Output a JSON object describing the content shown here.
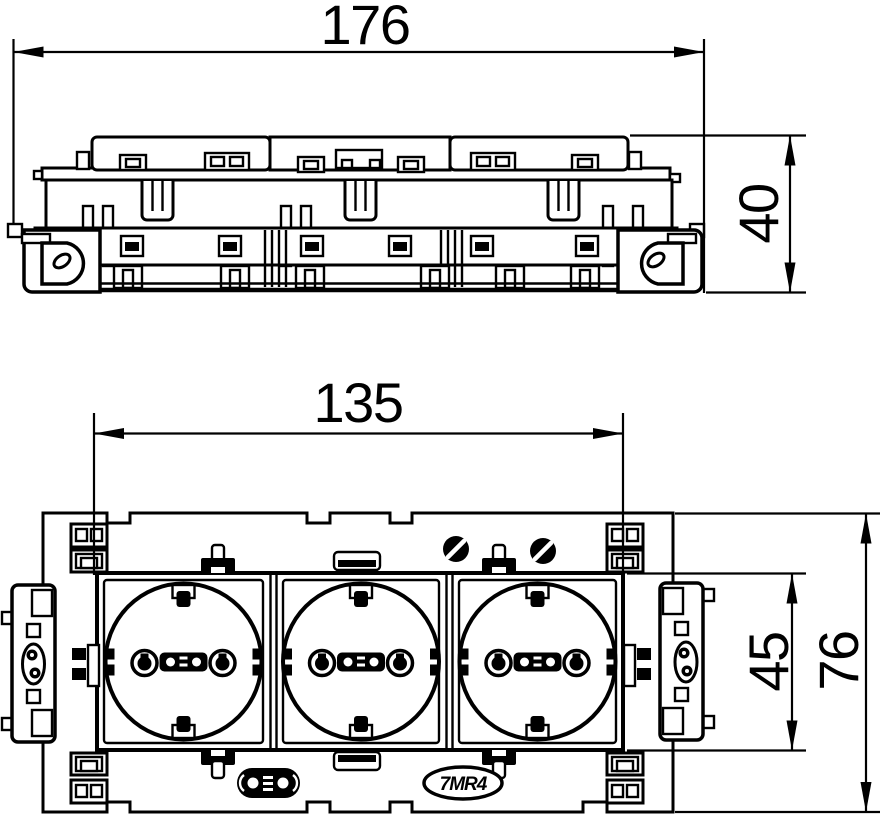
{
  "drawing": {
    "dimensions": {
      "overall_width": "176",
      "overall_depth": "40",
      "module_width": "135",
      "module_height": "45",
      "plate_height": "76"
    },
    "badge_text": "7MR4"
  }
}
